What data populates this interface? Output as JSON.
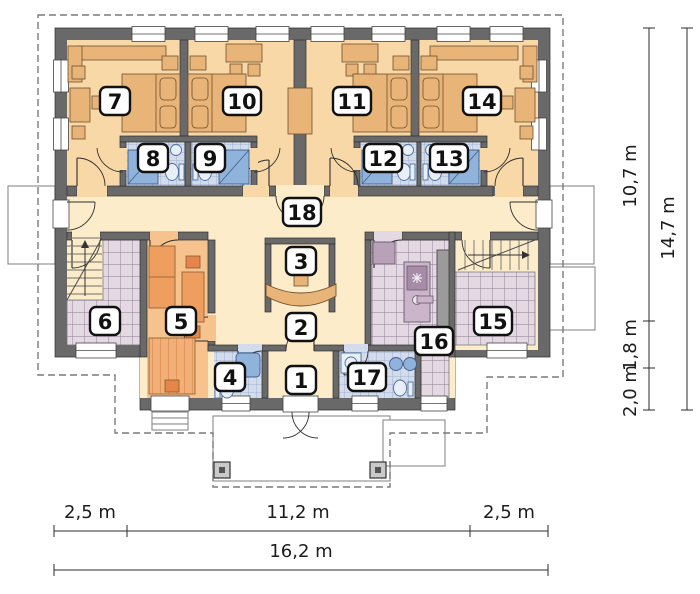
{
  "plan": {
    "type": "floor-plan",
    "rooms": [
      {
        "label": "1"
      },
      {
        "label": "2"
      },
      {
        "label": "3"
      },
      {
        "label": "4"
      },
      {
        "label": "5"
      },
      {
        "label": "6"
      },
      {
        "label": "7"
      },
      {
        "label": "8"
      },
      {
        "label": "9"
      },
      {
        "label": "10"
      },
      {
        "label": "11"
      },
      {
        "label": "12"
      },
      {
        "label": "13"
      },
      {
        "label": "14"
      },
      {
        "label": "15"
      },
      {
        "label": "16"
      },
      {
        "label": "17"
      },
      {
        "label": "18"
      }
    ],
    "dimensions": {
      "bottom_left": "2,5 m",
      "bottom_center": "11,2 m",
      "bottom_right": "2,5 m",
      "bottom_total": "16,2 m",
      "right_upper": "10,7 m",
      "right_middle": "1,8 m",
      "right_lower": "2,0 m",
      "right_total": "14,7 m"
    },
    "colors": {
      "wall": "#696969",
      "bedroom_floor": "#f8d8a6",
      "hall_floor": "#fcecca",
      "room5_floor": "#f6c28e",
      "tile_lavender": "#e4d8e3",
      "tile_blue": "#d3dcec",
      "furniture_tan": "#e9b477",
      "furniture_orange": "#ee9f60",
      "fixture_blue": "#8fb3da",
      "island_purple": "#cbb5cb",
      "roof_dash": "#7a7a7a"
    }
  }
}
